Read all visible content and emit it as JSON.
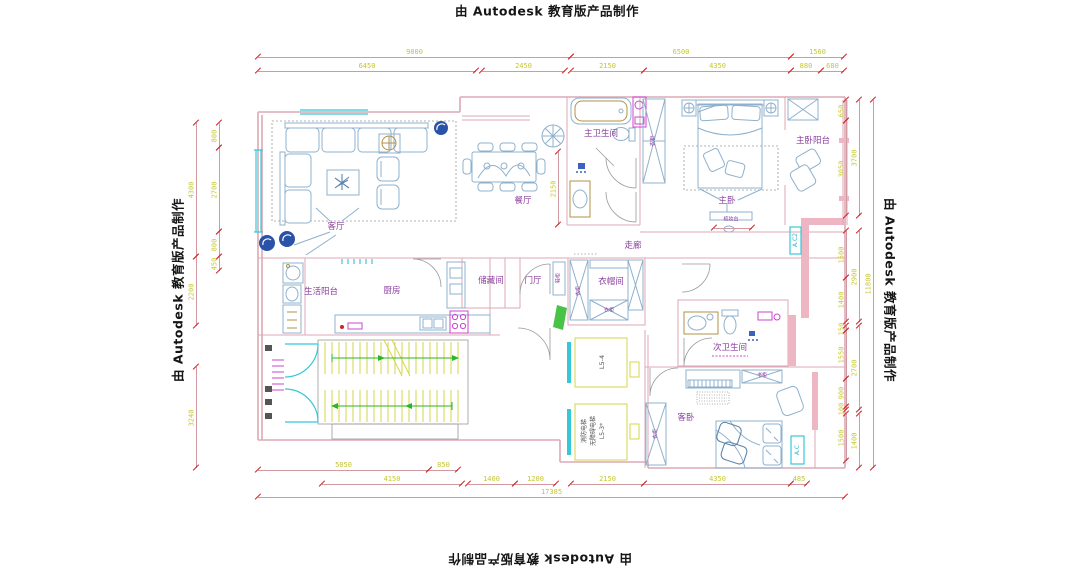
{
  "credit_text": "由 Autodesk 教育版产品制作",
  "colors": {
    "wall": "#dcaab6",
    "wallfill": "#eeb6c2",
    "furn": "#8fb0cc",
    "furnd": "#5e86ad",
    "win": "#35c8d8",
    "mag": "#cc44cc",
    "stair": "#d6d64a",
    "arrow": "#2ab52a",
    "label": "#8a3d9e",
    "dimline": "#cf9aa2",
    "dimtick": "#d22222",
    "dimtext": "#c6c630",
    "fan": "#2a52a8",
    "tan": "#b09048"
  },
  "room_labels": [
    {
      "name": "label-living-room",
      "text": "客厅",
      "x": 336,
      "y": 227
    },
    {
      "name": "label-dining-room",
      "text": "餐厅",
      "x": 523,
      "y": 201
    },
    {
      "name": "label-master-bathroom",
      "text": "主卫生间",
      "x": 601,
      "y": 134
    },
    {
      "name": "label-master-bedroom",
      "text": "主卧",
      "x": 727,
      "y": 201
    },
    {
      "name": "label-master-balcony",
      "text": "主卧阳台",
      "x": 813,
      "y": 141
    },
    {
      "name": "label-corridor",
      "text": "走廊",
      "x": 633,
      "y": 246
    },
    {
      "name": "label-storage-room",
      "text": "储藏间",
      "x": 491,
      "y": 281
    },
    {
      "name": "label-foyer",
      "text": "门厅",
      "x": 533,
      "y": 281
    },
    {
      "name": "label-cloakroom",
      "text": "衣帽间",
      "x": 611,
      "y": 282
    },
    {
      "name": "label-service-balcony",
      "text": "生活阳台",
      "x": 321,
      "y": 292
    },
    {
      "name": "label-kitchen",
      "text": "厨房",
      "x": 392,
      "y": 291
    },
    {
      "name": "label-second-bathroom",
      "text": "次卫生间",
      "x": 730,
      "y": 348
    },
    {
      "name": "label-guest-bedroom",
      "text": "客卧",
      "x": 686,
      "y": 418
    },
    {
      "name": "label-master-closet",
      "text": "衣柜",
      "x": 654,
      "y": 141,
      "rot": -90,
      "size": 5.5
    },
    {
      "name": "label-cloakroom-wardrobe-left",
      "text": "衣柜",
      "x": 579,
      "y": 291,
      "rot": -90,
      "size": 5
    },
    {
      "name": "label-cloakroom-wardrobe-bottom",
      "text": "衣柜",
      "x": 609,
      "y": 311,
      "size": 5
    },
    {
      "name": "label-shoe-cabinet",
      "text": "鞋柜",
      "x": 559,
      "y": 278,
      "rot": -90,
      "size": 5
    },
    {
      "name": "label-guest-wardrobe",
      "text": "衣柜",
      "x": 656,
      "y": 434,
      "rot": -90,
      "size": 5
    },
    {
      "name": "label-guest-bookcase",
      "text": "书柜",
      "x": 762,
      "y": 376,
      "size": 5
    },
    {
      "name": "label-dressing-table",
      "text": "梳妆台",
      "x": 731,
      "y": 220,
      "size": 5
    },
    {
      "name": "label-elevator-2",
      "text": "L5-4",
      "x": 602,
      "y": 362,
      "rot": -90,
      "size": 6.5,
      "color": "#555555"
    },
    {
      "name": "label-elevator-1a",
      "text": "消防电梯",
      "x": 585,
      "y": 431,
      "rot": -90,
      "size": 6,
      "color": "#555555"
    },
    {
      "name": "label-elevator-1b",
      "text": "无障碍电梯",
      "x": 594,
      "y": 431,
      "rot": -90,
      "size": 6,
      "color": "#555555"
    },
    {
      "name": "label-elevator-1c",
      "text": "L5-3*",
      "x": 603,
      "y": 431,
      "rot": -90,
      "size": 6,
      "color": "#555555"
    },
    {
      "name": "label-ac-guest",
      "text": "A.C",
      "x": 798,
      "y": 450,
      "rot": -90,
      "size": 6,
      "color": "#2ab6c6"
    },
    {
      "name": "label-ac-corridor",
      "text": "A.C2",
      "x": 796,
      "y": 240,
      "rot": -90,
      "size": 6,
      "color": "#2ab6c6"
    }
  ],
  "dimensions": [
    {
      "o": "h",
      "x": 258,
      "y": 57,
      "len": 313,
      "label": "9800"
    },
    {
      "o": "h",
      "x": 571,
      "y": 57,
      "len": 220,
      "label": "6500"
    },
    {
      "o": "h",
      "x": 791,
      "y": 57,
      "len": 53,
      "label": "1560"
    },
    {
      "o": "h",
      "x": 258,
      "y": 71,
      "len": 218,
      "label": "6450"
    },
    {
      "o": "h",
      "x": 482,
      "y": 71,
      "len": 83,
      "label": "2450"
    },
    {
      "o": "h",
      "x": 571,
      "y": 71,
      "len": 73,
      "label": "2150"
    },
    {
      "o": "h",
      "x": 644,
      "y": 71,
      "len": 147,
      "label": "4350"
    },
    {
      "o": "h",
      "x": 791,
      "y": 71,
      "len": 30,
      "label": "880"
    },
    {
      "o": "h",
      "x": 821,
      "y": 71,
      "len": 23,
      "label": "680"
    },
    {
      "o": "h",
      "x": 258,
      "y": 470,
      "len": 171,
      "label": "5050"
    },
    {
      "o": "h",
      "x": 429,
      "y": 470,
      "len": 29,
      "label": "850"
    },
    {
      "o": "h",
      "x": 322,
      "y": 484,
      "len": 140,
      "label": "4150"
    },
    {
      "o": "h",
      "x": 468,
      "y": 484,
      "len": 47,
      "label": "1400"
    },
    {
      "o": "h",
      "x": 515,
      "y": 484,
      "len": 41,
      "label": "1200"
    },
    {
      "o": "h",
      "x": 571,
      "y": 484,
      "len": 73,
      "label": "2150"
    },
    {
      "o": "h",
      "x": 644,
      "y": 484,
      "len": 147,
      "label": "4350"
    },
    {
      "o": "h",
      "x": 791,
      "y": 484,
      "len": 16,
      "label": "485"
    },
    {
      "o": "h",
      "x": 258,
      "y": 497,
      "len": 587,
      "label": "17385"
    },
    {
      "o": "v",
      "x": 196,
      "y": 123,
      "len": 134,
      "label": "4300"
    },
    {
      "o": "v",
      "x": 196,
      "y": 257,
      "len": 69,
      "label": "2200"
    },
    {
      "o": "v",
      "x": 196,
      "y": 367,
      "len": 101,
      "label": "3240"
    },
    {
      "o": "v",
      "x": 219,
      "y": 123,
      "len": 25,
      "label": "800"
    },
    {
      "o": "v",
      "x": 219,
      "y": 148,
      "len": 84,
      "label": "2700"
    },
    {
      "o": "v",
      "x": 219,
      "y": 232,
      "len": 25,
      "label": "800"
    },
    {
      "o": "v",
      "x": 219,
      "y": 257,
      "len": 14,
      "label": "450"
    },
    {
      "o": "v",
      "x": 846,
      "y": 100,
      "len": 21,
      "label": "650"
    },
    {
      "o": "v",
      "x": 846,
      "y": 121,
      "len": 95,
      "label": "3050"
    },
    {
      "o": "v",
      "x": 846,
      "y": 231,
      "len": 47,
      "label": "1500"
    },
    {
      "o": "v",
      "x": 846,
      "y": 278,
      "len": 44,
      "label": "1400"
    },
    {
      "o": "v",
      "x": 846,
      "y": 326,
      "len": 5,
      "label": "150"
    },
    {
      "o": "v",
      "x": 846,
      "y": 331,
      "len": 48,
      "label": "1550"
    },
    {
      "o": "v",
      "x": 846,
      "y": 379,
      "len": 28,
      "label": "900"
    },
    {
      "o": "v",
      "x": 846,
      "y": 407,
      "len": 3,
      "label": "100"
    },
    {
      "o": "v",
      "x": 846,
      "y": 414,
      "len": 47,
      "label": "1500"
    },
    {
      "o": "v",
      "x": 859,
      "y": 100,
      "len": 116,
      "label": "3700"
    },
    {
      "o": "v",
      "x": 859,
      "y": 231,
      "len": 91,
      "label": "2900"
    },
    {
      "o": "v",
      "x": 859,
      "y": 326,
      "len": 84,
      "label": "2700"
    },
    {
      "o": "v",
      "x": 859,
      "y": 414,
      "len": 54,
      "label": "1400"
    },
    {
      "o": "v",
      "x": 873,
      "y": 100,
      "len": 368,
      "label": "11800"
    },
    {
      "o": "v",
      "x": 558,
      "y": 152,
      "len": 73,
      "label": "2150"
    },
    {
      "o": "h",
      "x": 714,
      "y": 228,
      "len": 38,
      "label": ""
    }
  ]
}
